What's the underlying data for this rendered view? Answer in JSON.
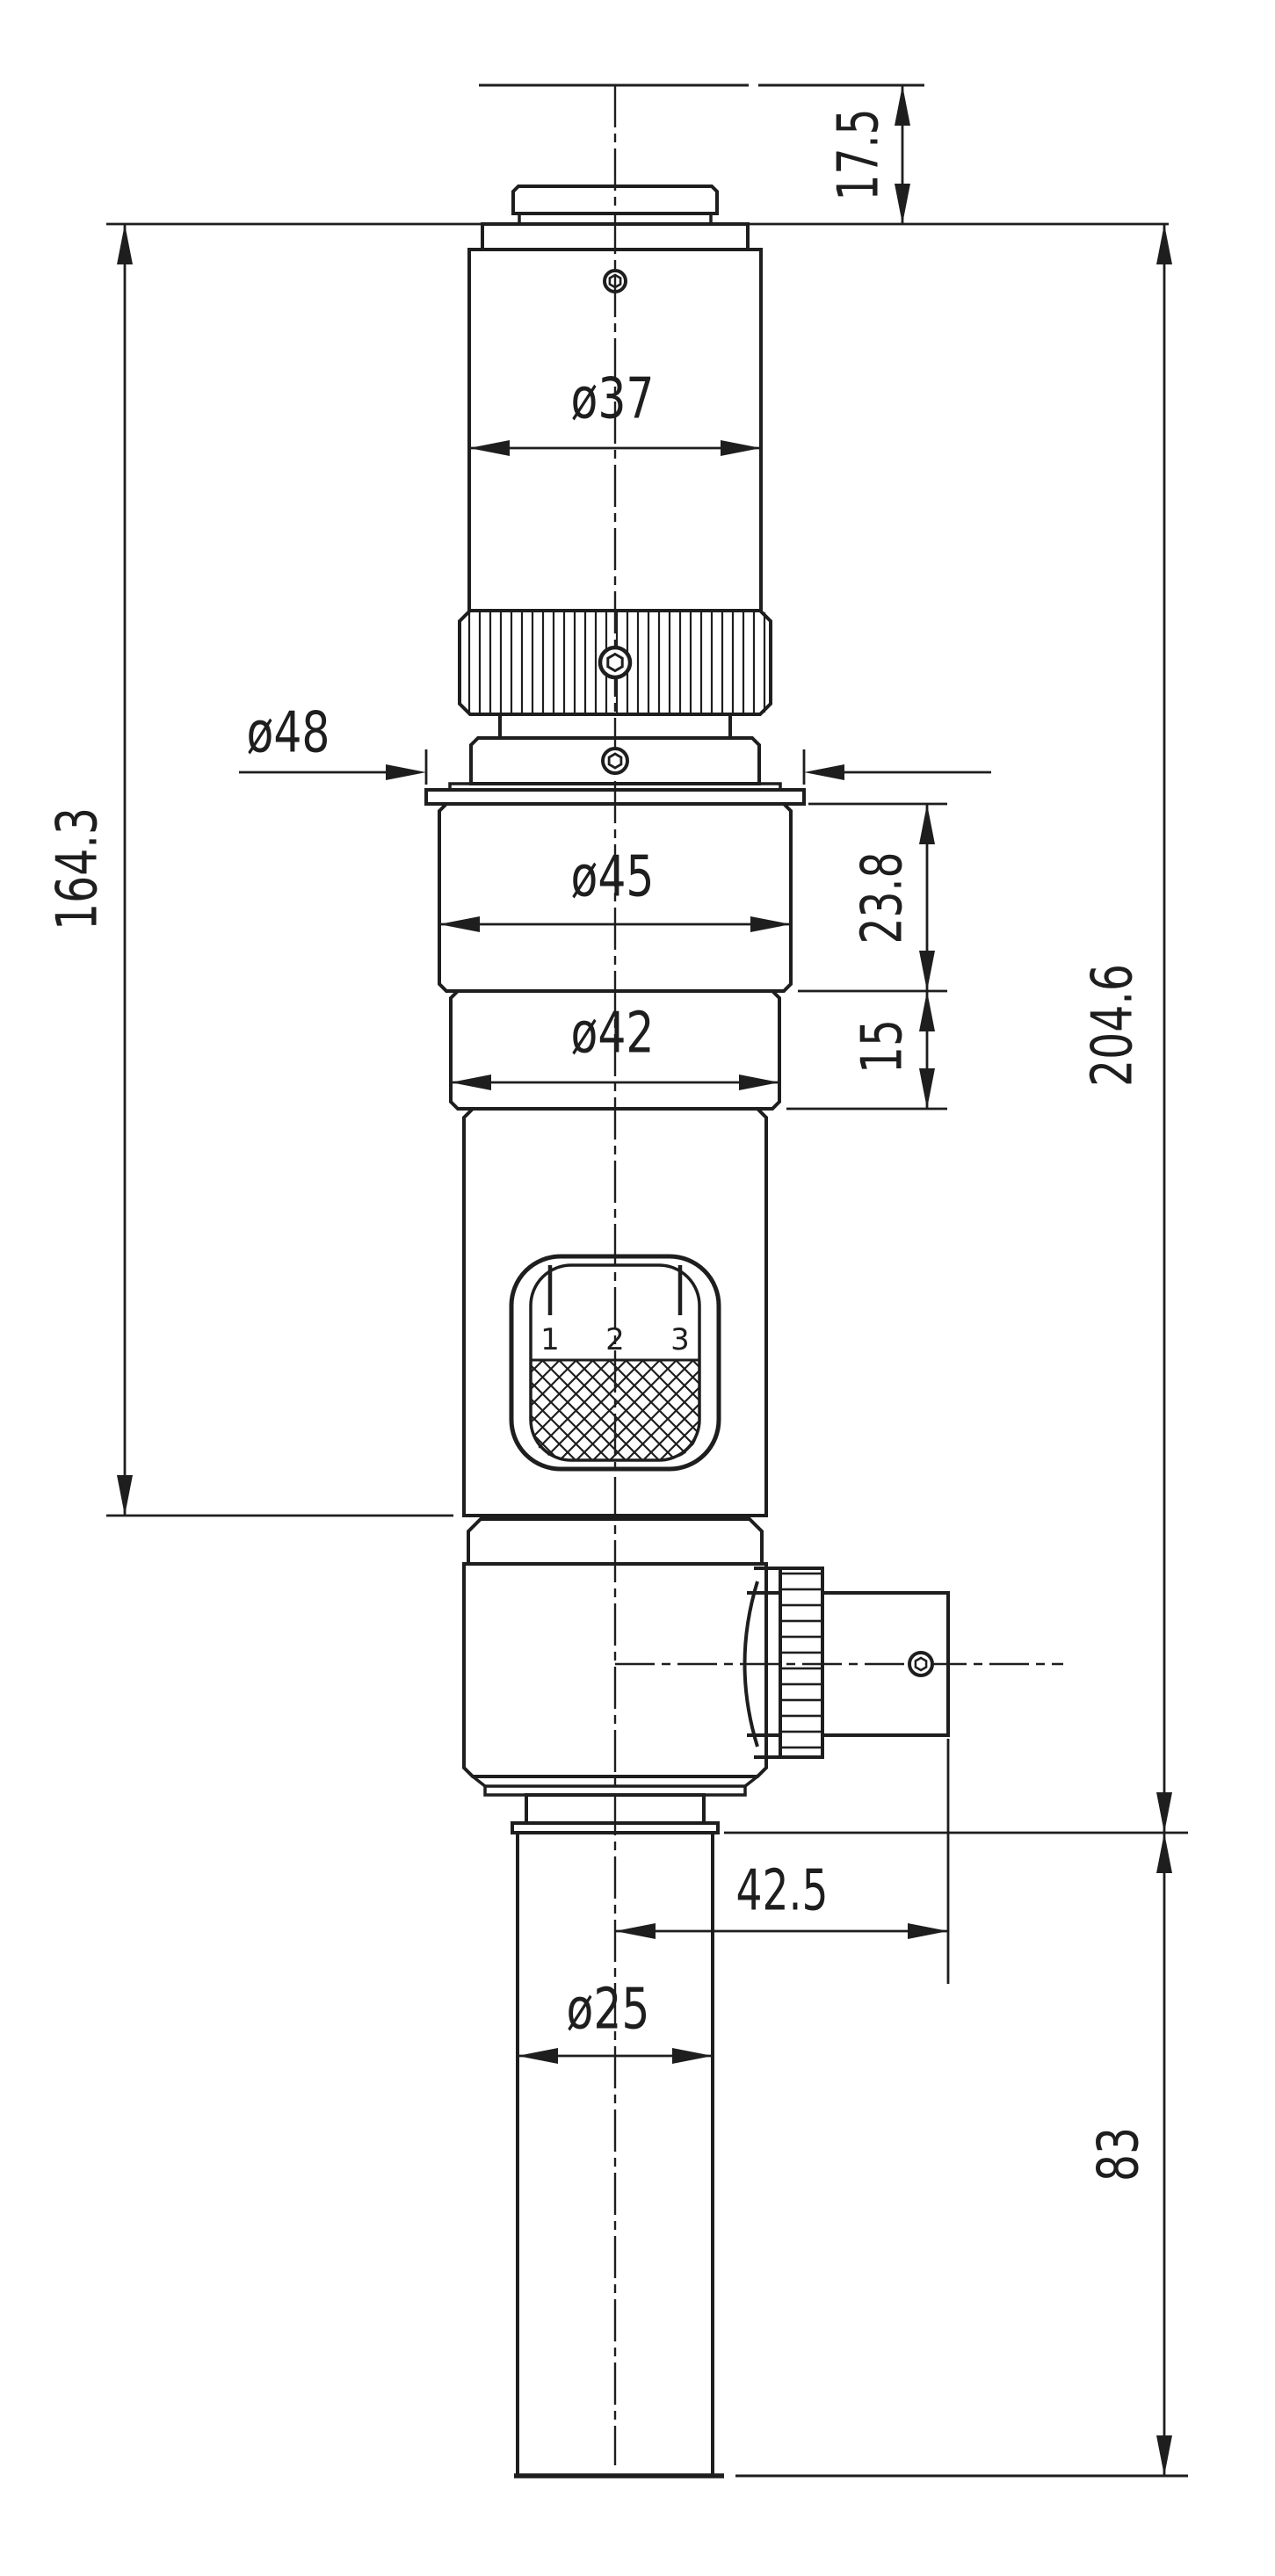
{
  "drawing": {
    "type": "technical-dimension-drawing",
    "subject": "microscope video adapter / C-mount optical tube, side elevation",
    "background_color": "#ffffff",
    "line_color": "#1e1e1e",
    "labels": {
      "cap_height": "17.5",
      "upper_tube_diameter": "ø37",
      "flange_diameter": "ø48",
      "upper_assembly_height": "164.3",
      "ring45_diameter": "ø45",
      "ring45_height": "23.8",
      "ring42_diameter": "ø42",
      "ring42_height": "15",
      "overall_height": "204.6",
      "connector_offset": "42.5",
      "lower_tube_diameter": "ø25",
      "lower_tube_height": "83"
    },
    "window_scale": [
      "1",
      "2",
      "3"
    ]
  }
}
